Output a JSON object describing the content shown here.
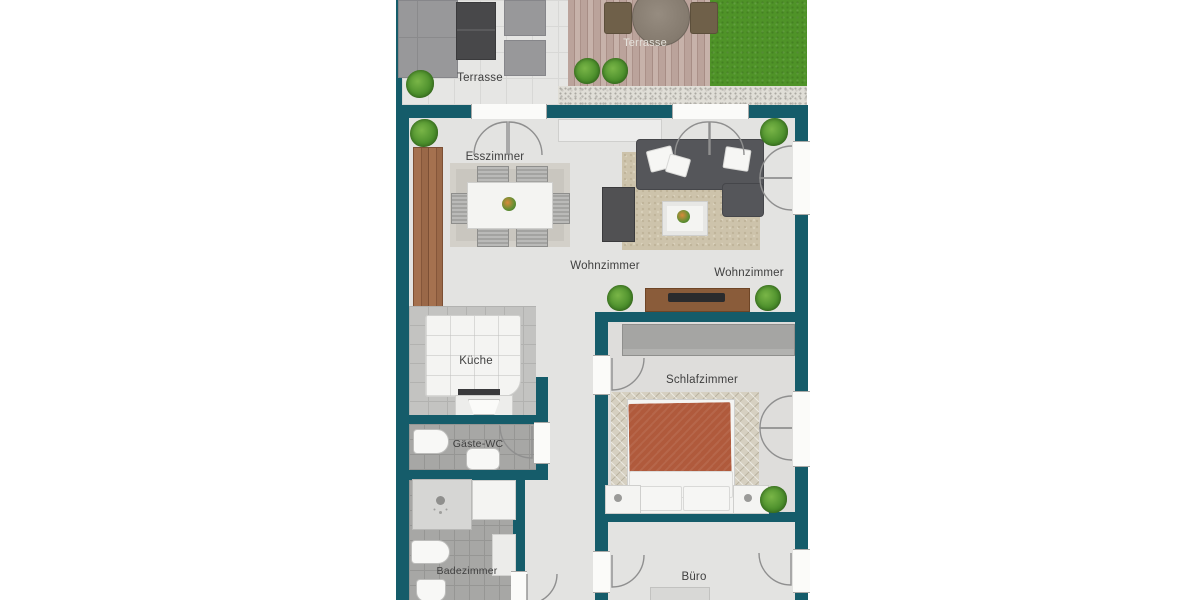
{
  "rooms": {
    "terrace_left": {
      "label": "Terrasse"
    },
    "terrace_deck": {
      "label": "Terrasse"
    },
    "dining": {
      "label": "Esszimmer"
    },
    "living_a": {
      "label": "Wohnzimmer"
    },
    "living_b": {
      "label": "Wohnzimmer"
    },
    "kitchen": {
      "label": "Küche"
    },
    "guest_wc": {
      "label": "Gäste-WC"
    },
    "bedroom": {
      "label": "Schlafzimmer"
    },
    "bathroom": {
      "label": "Badezimmer"
    },
    "office": {
      "label": "Büro"
    }
  },
  "colors": {
    "wall": "#155c6a",
    "lawn": "#4f9328",
    "gravel": "#e0ded7",
    "tile": "#e6e6e4",
    "floor": "#e3e3e1",
    "tile_dark": "#a7a7a5",
    "kitchen_floor": "#c3c3c1",
    "rug_gray": "#c9c6bf",
    "rug_beige": "#cdc3ab",
    "rug_bed": "#d6d0c1",
    "sofa": "#55565a",
    "white_furniture": "#f4f4f2",
    "bed_cover": "#b05a3c",
    "wood_board": "#8a5c3a",
    "wardrobe": "#a5a5a3",
    "plant": "#4c8f2c",
    "label": "#3f3f3f",
    "label_light": "#e4e1da"
  }
}
